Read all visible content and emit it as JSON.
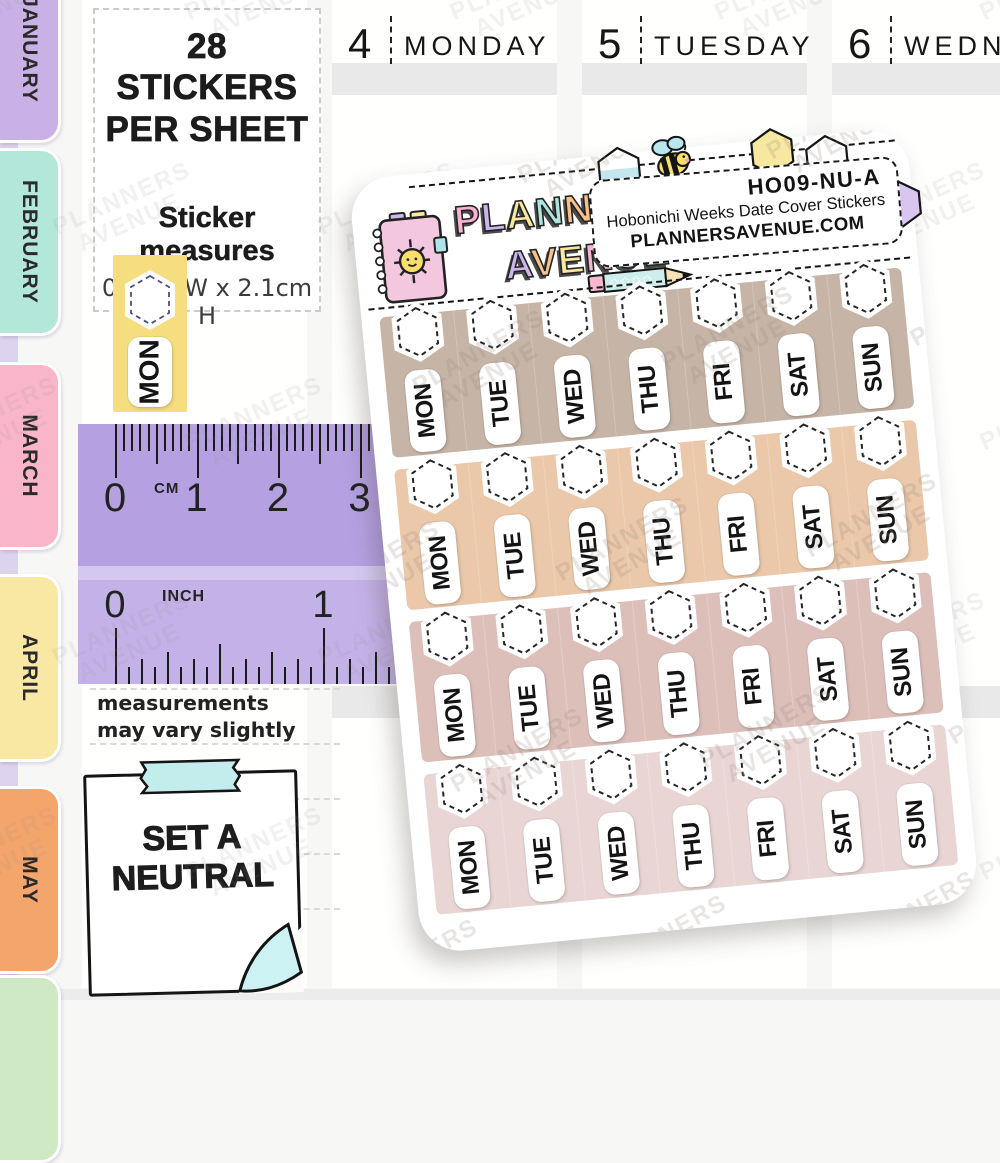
{
  "page": {
    "background": "#f7f7f6"
  },
  "tabs": {
    "strip_color": "#ddd3ee",
    "months": [
      {
        "label": "JANUARY",
        "color": "#c9b1e6"
      },
      {
        "label": "FEBRUARY",
        "color": "#b3e7da"
      },
      {
        "label": "MARCH",
        "color": "#f9b6cb"
      },
      {
        "label": "APRIL",
        "color": "#f8e8a4"
      },
      {
        "label": "MAY",
        "color": "#f3a56c"
      }
    ],
    "partial_tab_color": "#cfe9c4"
  },
  "planner": {
    "days": [
      {
        "number": "4",
        "name": "MONDAY"
      },
      {
        "number": "5",
        "name": "TUESDAY"
      },
      {
        "number": "6",
        "name": "WEDNESDAY"
      }
    ]
  },
  "info_box": {
    "title_line1": "28 STICKERS",
    "title_line2": "PER SHEET",
    "measures_label": "Sticker measures",
    "measures_value": "0.8cm W  x  2.1cm H"
  },
  "sample_sticker": {
    "day": "MON",
    "color": "#f6dd80"
  },
  "ruler": {
    "color": "#b5a1e2",
    "cm_label": "CM",
    "cm_numbers": [
      "0",
      "1",
      "2",
      "3"
    ],
    "inch_label": "INCH",
    "inch_numbers": [
      "0",
      "1"
    ]
  },
  "disclaimer": {
    "line1": "measurements",
    "line2": "may vary slightly"
  },
  "sticky_note": {
    "line1": "SET A",
    "line2": "NEUTRAL",
    "tape_color": "#c3ecec",
    "fold_color": "#cdf2f4"
  },
  "sheet": {
    "sku": "HO09-NU-A",
    "product_title": "Hobonichi Weeks Date Cover Stickers",
    "website": "PLANNERSAVENUE.COM",
    "brand": {
      "line1": "PLANNERS",
      "line2": "AVENUE",
      "letter_colors_line1": [
        "#f7b1d2",
        "#cbb5ec",
        "#f8e79e",
        "#b0e6df",
        "#f8c18b",
        "#d6c2f2",
        "#f7b1d2",
        "#f393bf"
      ],
      "letter_colors_line2": [
        "#cbb5ec",
        "#f8c18b",
        "#f8e79e",
        "#f7b1d2",
        "#d6c2f2",
        "#b0e6df"
      ]
    },
    "days": [
      "MON",
      "TUE",
      "WED",
      "THU",
      "FRI",
      "SAT",
      "SUN"
    ],
    "rows": [
      {
        "color": "#c6b4a6"
      },
      {
        "color": "#eac8a9"
      },
      {
        "color": "#ddbfba"
      },
      {
        "color": "#e9d6d4"
      }
    ]
  },
  "watermark": {
    "line1": "PLANNERS",
    "line2": "AVENUE"
  }
}
